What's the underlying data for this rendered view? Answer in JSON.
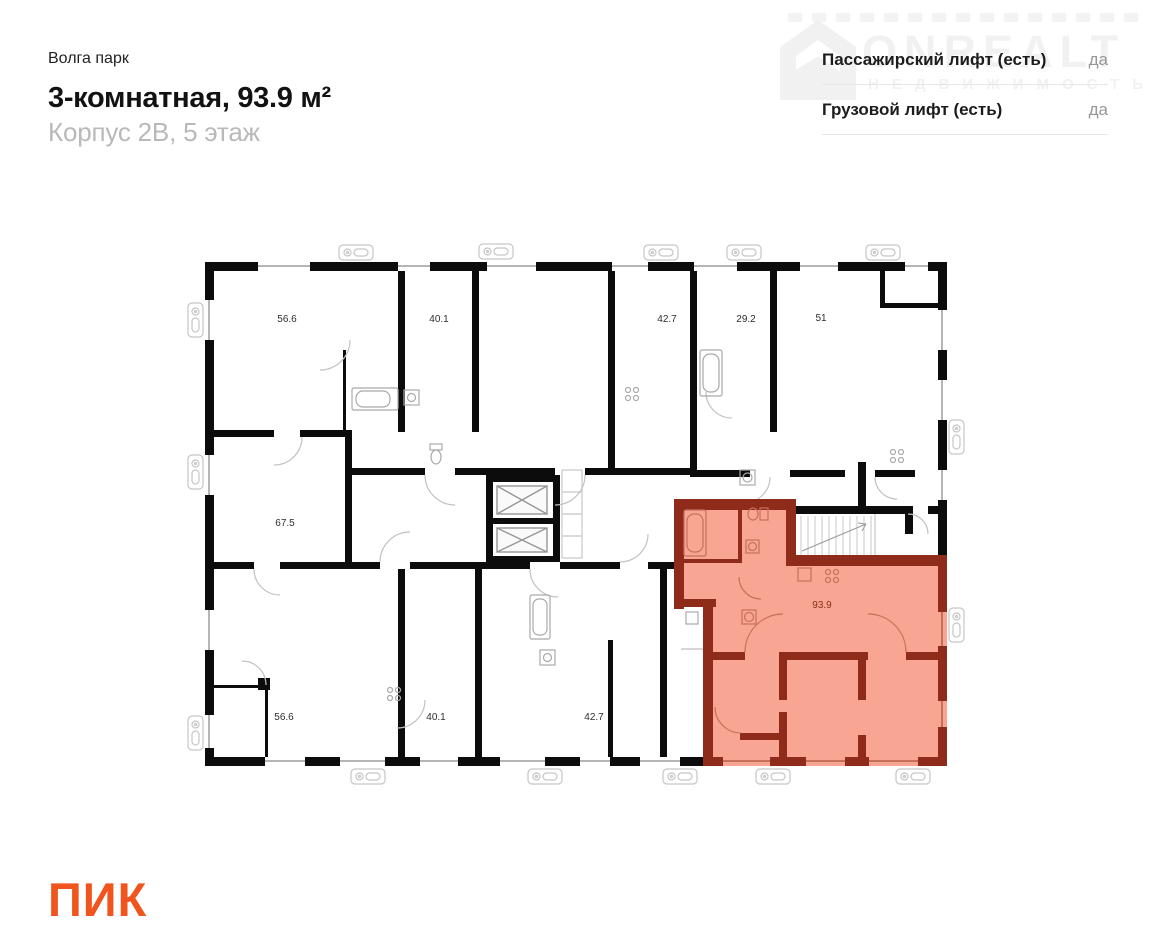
{
  "header": {
    "project": "Волга парк",
    "title": "3-комнатная, 93.9 м²",
    "subtitle": "Корпус 2В, 5 этаж"
  },
  "info": {
    "rows": [
      {
        "label": "Пассажирский лифт (есть)",
        "value": "да"
      },
      {
        "label": "Грузовой лифт (есть)",
        "value": "да"
      }
    ]
  },
  "watermark": {
    "brand": "ONREALT",
    "subtext": "НЕДВИЖИМОСТЬ",
    "icon": "house-icon"
  },
  "logo": {
    "text": "ПИК",
    "color": "#F0551E"
  },
  "plan": {
    "highlight_fill": "#F9A593",
    "highlight_wall": "#8E2B1B",
    "wall_color": "#0c0c0c",
    "labels": [
      {
        "value": "56.6",
        "highlighted": false
      },
      {
        "value": "40.1",
        "highlighted": false
      },
      {
        "value": "42.7",
        "highlighted": false
      },
      {
        "value": "29.2",
        "highlighted": false
      },
      {
        "value": "51",
        "highlighted": false
      },
      {
        "value": "67.5",
        "highlighted": false
      },
      {
        "value": "56.6",
        "highlighted": false
      },
      {
        "value": "40.1",
        "highlighted": false
      },
      {
        "value": "42.7",
        "highlighted": false
      },
      {
        "value": "93.9",
        "highlighted": true
      }
    ]
  }
}
